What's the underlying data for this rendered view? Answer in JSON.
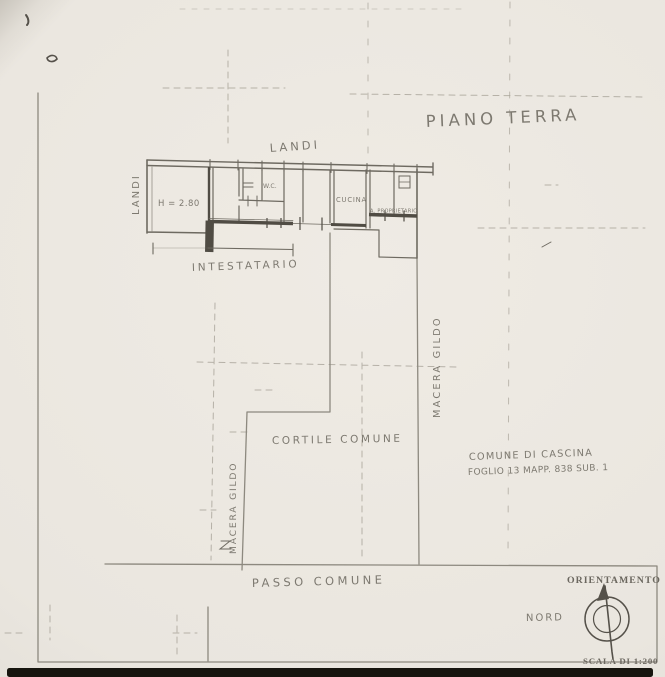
{
  "sheet": {
    "title": "PIANO TERRA",
    "building": {
      "owner_top": "LANDI",
      "owner_left": "LANDI",
      "room_height": "H = 2.80",
      "wc": "W.C.",
      "kitchen": "CUCINA",
      "other_owner": "A. PROPRIETARIO",
      "holder": "INTESTATARIO"
    },
    "boundaries": {
      "neighbor_right": "MACERA GILDO",
      "neighbor_left": "MACERA GILDO",
      "courtyard": "CORTILE COMUNE",
      "passage": "PASSO COMUNE"
    },
    "cadastre": {
      "line1": "COMUNE DI CASCINA",
      "line2": "FOGLIO 13 MAPP. 838 SUB. 1"
    },
    "orientation": {
      "label": "ORIENTAMENTO",
      "north": "NORD"
    },
    "scale": "SCALA DI 1:200"
  },
  "colors": {
    "paper": "#eae6df",
    "pencil": "#7d7970",
    "ink": "#55514a",
    "wall_dark": "#504c44",
    "faint": "#a8a399",
    "band": "#17150f"
  }
}
